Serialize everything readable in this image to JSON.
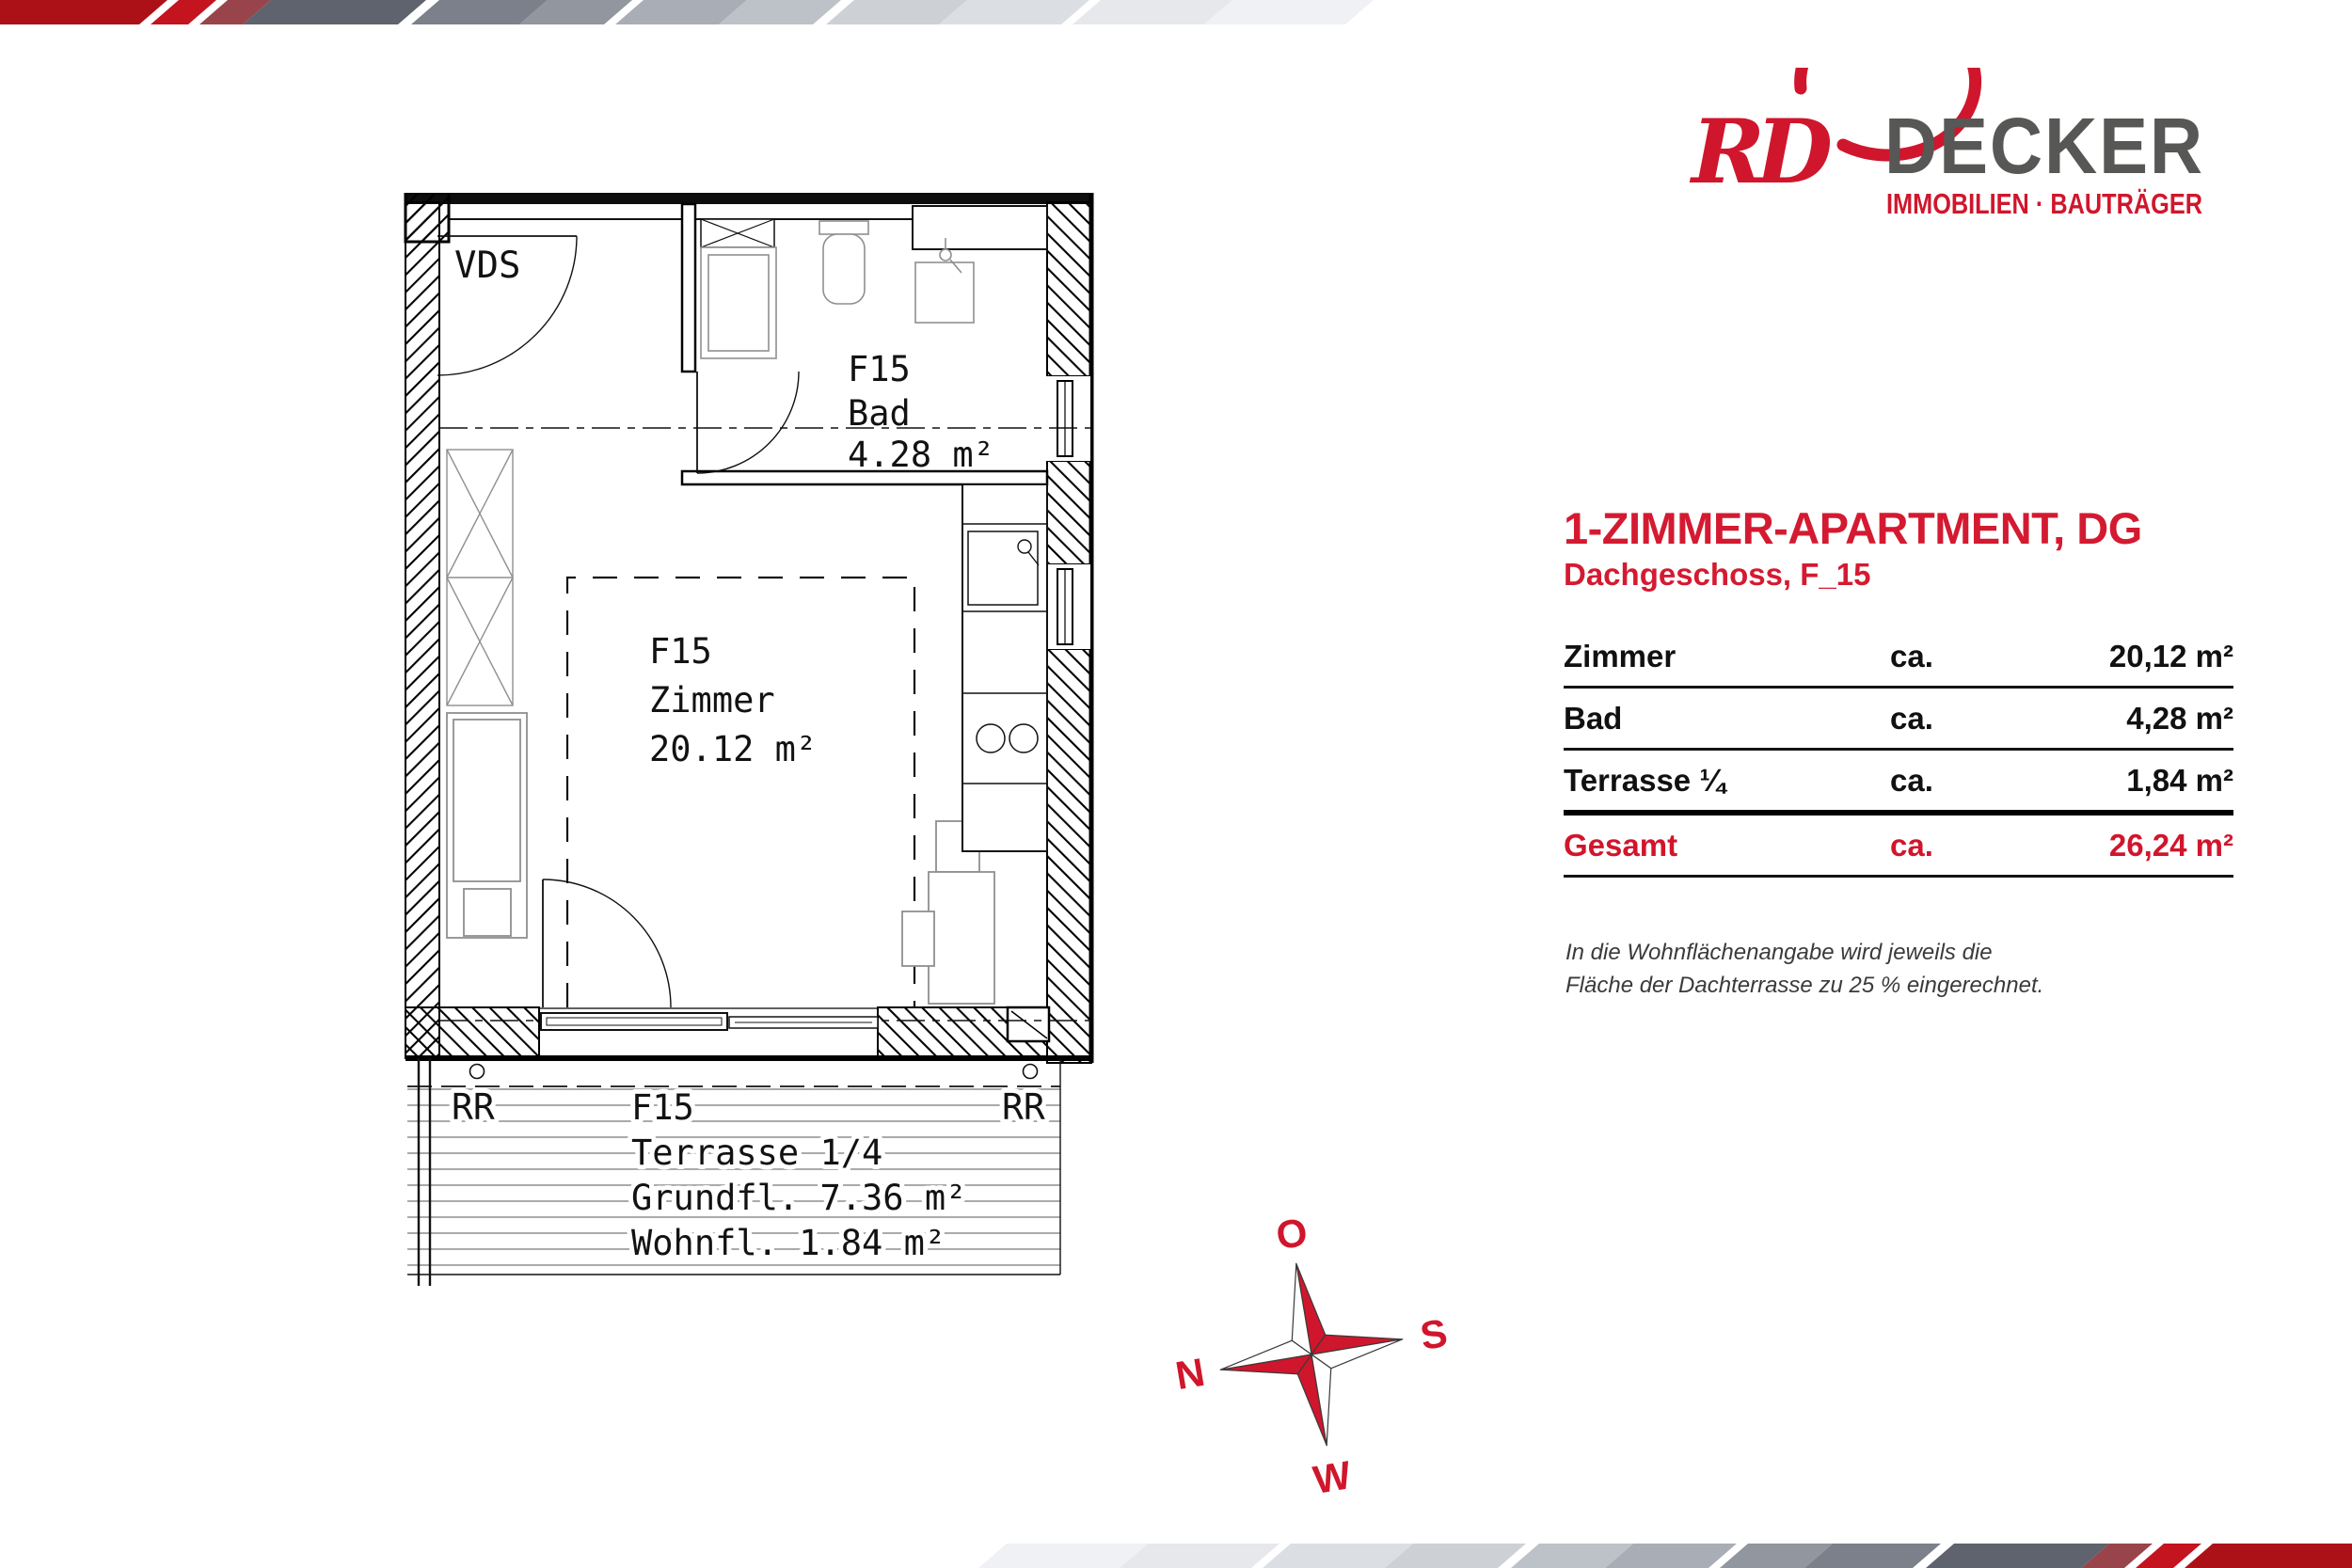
{
  "theme": {
    "brand_red": "#d0162c",
    "title_red": "#d41a31",
    "brand_gray": "#575756",
    "note_gray": "#3a3a39",
    "plan_line": "#121212",
    "furniture_gray": "#8f8f8f",
    "deck_gray": "#9a9a9a"
  },
  "brand": {
    "monogram": "RD",
    "name": "DECKER",
    "tagline": "IMMOBILIEN · BAUTRÄGER"
  },
  "header": {
    "title": "1-ZIMMER-APARTMENT, DG",
    "subtitle": "Dachgeschoss, F_15"
  },
  "area_table": {
    "rows": [
      {
        "label": "Zimmer",
        "approx": "ca.",
        "value": "20,12 m²"
      },
      {
        "label": "Bad",
        "approx": "ca.",
        "value": "4,28 m²"
      },
      {
        "label": "Terrasse ¼",
        "approx": "ca.",
        "value": "1,84 m²"
      },
      {
        "label": "Gesamt",
        "approx": "ca.",
        "value": "26,24 m²"
      }
    ]
  },
  "note": {
    "lines": [
      "In die Wohnflächenangabe wird jeweils die",
      "Fläche der Dachterrasse zu 25 % eingerechnet."
    ]
  },
  "floor_plan": {
    "entry_label": "VDS",
    "bath": {
      "unit": "F15",
      "name": "Bad",
      "area": "4.28 m²"
    },
    "room": {
      "unit": "F15",
      "name": "Zimmer",
      "area": "20.12 m²"
    },
    "terrace": {
      "rr_left": "RR",
      "rr_right": "RR",
      "unit": "F15",
      "name": "Terrasse 1/4",
      "ground_area": "Grundfl. 7.36 m²",
      "living_area": "Wohnfl. 1.84 m²"
    }
  },
  "compass": {
    "top": "O",
    "right": "S",
    "bottom": "W",
    "left": "N"
  },
  "decor": {
    "stripes": [
      {
        "c": "#ad1118",
        "w": 148,
        "g": 12
      },
      {
        "c": "#c3141f",
        "w": 40,
        "g": 12
      },
      {
        "c": "#99444b",
        "w": 46,
        "g": 0
      },
      {
        "c": "#5e636d",
        "w": 165,
        "g": 14
      },
      {
        "c": "#7b808a",
        "w": 115,
        "g": 0
      },
      {
        "c": "#91969f",
        "w": 90,
        "g": 12
      },
      {
        "c": "#a9aeb6",
        "w": 110,
        "g": 0
      },
      {
        "c": "#bdc2c8",
        "w": 100,
        "g": 14
      },
      {
        "c": "#cdd1d6",
        "w": 120,
        "g": 0
      },
      {
        "c": "#dbdee2",
        "w": 130,
        "g": 12
      },
      {
        "c": "#e6e8ec",
        "w": 140,
        "g": 0
      },
      {
        "c": "#f0f1f4",
        "w": 150,
        "g": 10
      }
    ]
  }
}
